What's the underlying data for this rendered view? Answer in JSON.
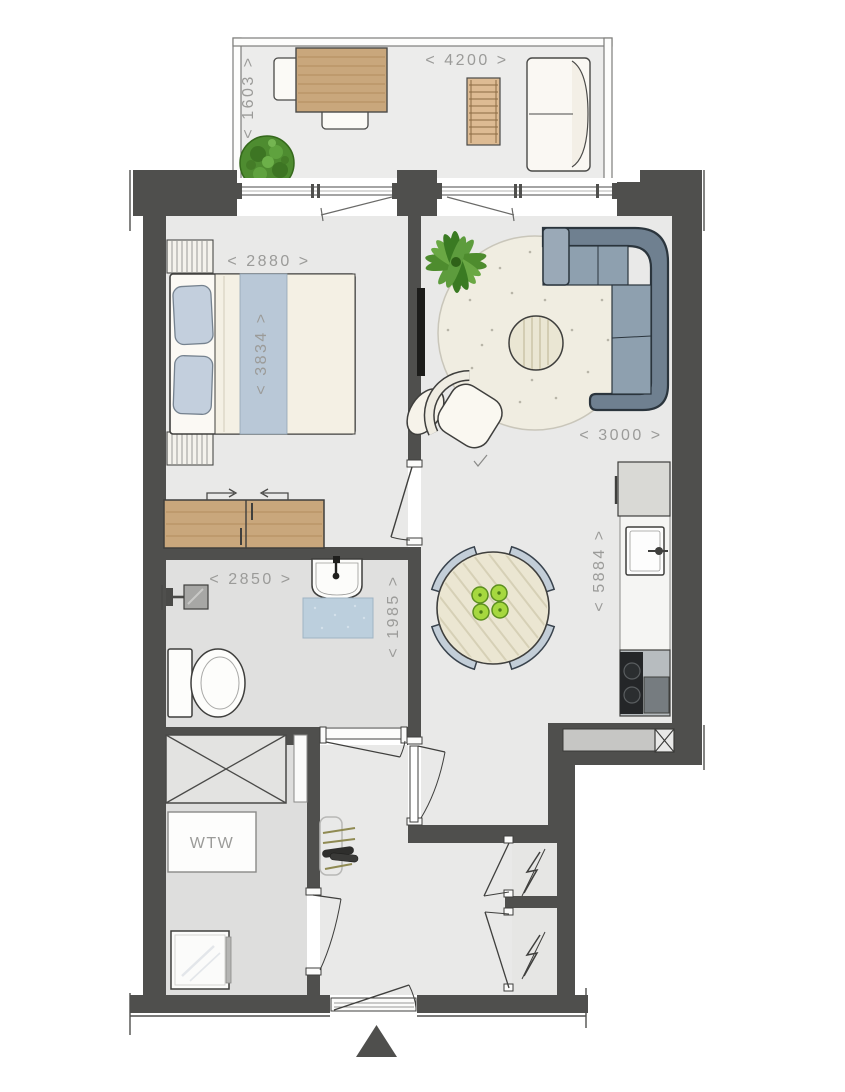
{
  "floorplan": {
    "type": "apartment-floor-plan",
    "dimension_labels": {
      "balcony_width": "< 4200 >",
      "balcony_depth": "< 1603 >",
      "bedroom_width": "< 2880 >",
      "bedroom_length": "< 3834 >",
      "living_width": "< 3000 >",
      "living_length": "< 5884 >",
      "bathroom_width": "< 2850 >",
      "bathroom_depth": "< 1985 >"
    },
    "text_labels": {
      "ventilation_unit": "WTW"
    },
    "icons": {
      "entrance_marker": "solid-triangle",
      "electrical_closet": "lightning-bolt",
      "shower": "shower-head",
      "plants": [
        "bush",
        "palm"
      ]
    },
    "colors": {
      "wall": "#4f4f4d",
      "floor_main": "#e9e9e8",
      "floor_wet": "#e0e0df",
      "floor_storage": "#dededd",
      "balcony_floor": "#ececeb",
      "wood": "#c9a77c",
      "sofa": "#8395a4",
      "textile_blue": "#bccfdd",
      "apple_green": "#a6d83f",
      "dimension_text": "#9b9b99"
    }
  }
}
